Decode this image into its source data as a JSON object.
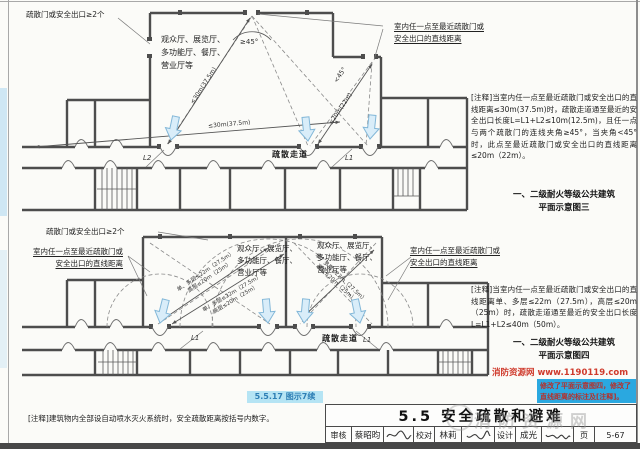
{
  "colors": {
    "wall": "#4d4d4d",
    "highlight_cyan": "#b5e4f4",
    "badge_blue": "#2aa8e0",
    "credit_red": "#cf3a2c",
    "arrow_fill": "#d9edf9"
  },
  "diagram3": {
    "exits_label": "疏散门或安全出口≥2个",
    "rooms_label": "观众厅、展览厅、\n多功能厅、餐厅、\n营业厅等",
    "distance_label": "室内任一点至最近疏散门或\n安全出口的直线距离",
    "dim_30m_diag": "≤30m(37.5m)",
    "dim_30m_long": "≤30m(37.5m)",
    "dim_20m": "≤20m(22m)",
    "angle_min": "≥45°",
    "angle_less": "<45°",
    "corridor_label": "疏散走道",
    "seg_l2": "L2",
    "seg_l1": "L1",
    "note": "[注释]当室内任一点至最近疏散门或安全出口的直线距离≤30m(37.5m)时，疏散走道通至最近的安全出口长度L=L1+L2≤10m(12.5m)，且任一点与两个疏散门的连线夹角≥45°，当夹角<45°时，此点至最近疏散门或安全出口的直线距离≤20m（22m）。",
    "caption": "一、二级耐火等级公共建筑\n平面示意图三"
  },
  "diagram4": {
    "exits_label": "疏散门或安全出口≥2个",
    "rooms_label_left": "观众厅、展览厅、\n多功能厅、餐厅、\n营业厅等",
    "rooms_label_right": "观众厅、展览厅、\n多功能厅、餐厅、\n营业厅等",
    "distance_label_left": "室内任一点至最近疏散门或\n安全出口的直线距离",
    "distance_label_right": "室内任一点至最近疏散门或\n安全出口的直线距离",
    "dim_multi": "单、多层≤22m（27.5m）",
    "dim_high": "高层≤20m（25m）",
    "corridor_label": "疏散走道",
    "seg_l1_left": "L1",
    "seg_l1_right": "L1",
    "note": "[注释]当室内任一点至最近疏散门或安全出口的直线距离单、多层≤22m（27.5m），高层≤20m（25m）时，疏散走道通至最近的安全出口长度L=L1+L2≤40m（50m）。",
    "caption": "一、二级耐火等级公共建筑\n平面示意图四"
  },
  "footer": {
    "figure_ref": "5.5.17 图示7续",
    "sprinkler_note": "[注释]建筑物内全部设自动喷水灭火系统时，安全疏散距离按括号内数字。",
    "site_credit": "消防资源网 www.1190119.com",
    "revision_badge": "修改了平面示意图四，修改了直线距离的标注及[注释]。",
    "watermark": "消防资源网",
    "section_title": "5.5 安全疏散和避难",
    "titleblock": {
      "review_label": "审核",
      "review_name": "蔡昭昀",
      "check_label": "校对",
      "check_name": "林莉",
      "design_label": "设计",
      "design_name": "成光",
      "page_label": "页",
      "page_number": "5-67"
    }
  }
}
